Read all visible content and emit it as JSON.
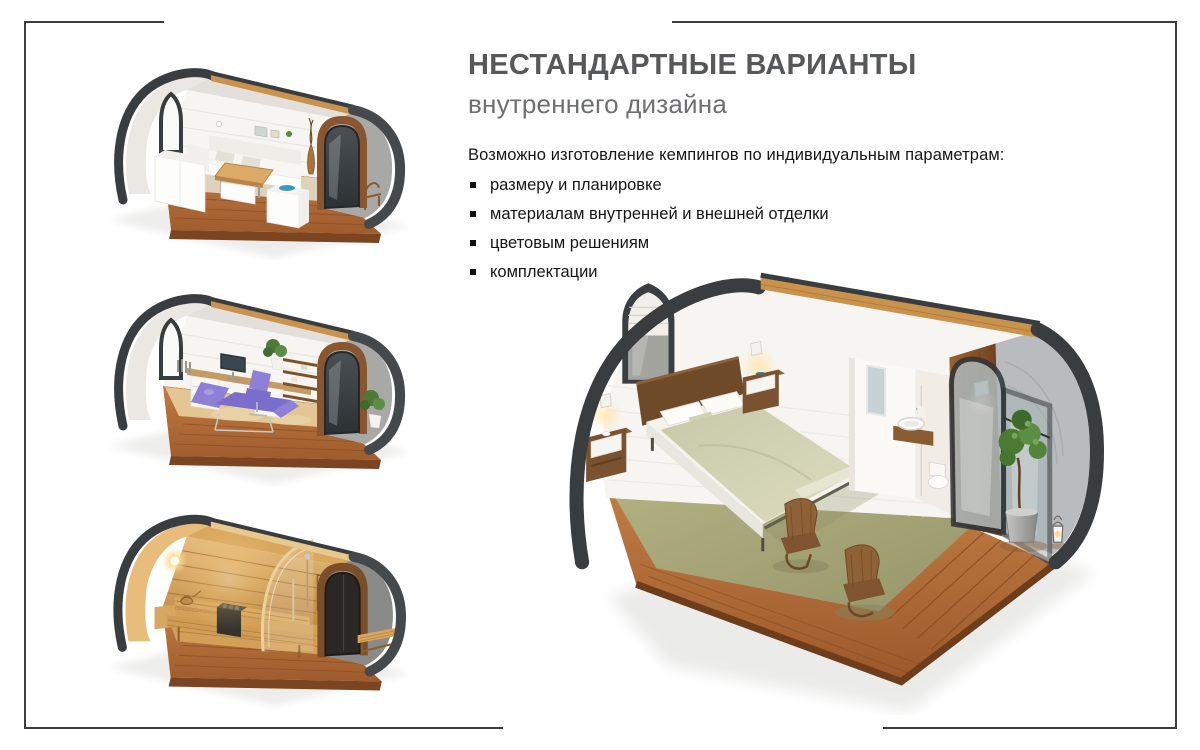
{
  "header": {
    "title": "НЕСТАНДАРТНЫЕ ВАРИАНТЫ",
    "subtitle": "внутреннего дизайна"
  },
  "body": {
    "intro": "Возможно изготовление кемпингов по индивидуальным параметрам:",
    "bullets": [
      "размеру и планировке",
      "материалам внутренней и внешней отделки",
      "цветовым решениям",
      "комплектации"
    ]
  },
  "images": {
    "pod_lounge": "camping-pod-cutaway-lounge-dining-interior",
    "pod_office": "camping-pod-cutaway-massage-office-interior",
    "pod_sauna": "camping-pod-cutaway-sauna-interior",
    "pod_bedroom": "camping-pod-cutaway-bedroom-with-bathroom"
  },
  "palette": {
    "frame": "#3b3e40",
    "title_gray": "#57585a",
    "subtitle_gray": "#6e6f71",
    "text_black": "#161616",
    "shell_dark": "#3a3d40",
    "deck_wood": "#b5713a",
    "ridge_wood": "#c9934e",
    "carpet_olive": "#a7a678",
    "blanket_sage": "#ccCFae",
    "accent_purple": "#8d80d6",
    "sauna_amber": "#d9a860"
  }
}
